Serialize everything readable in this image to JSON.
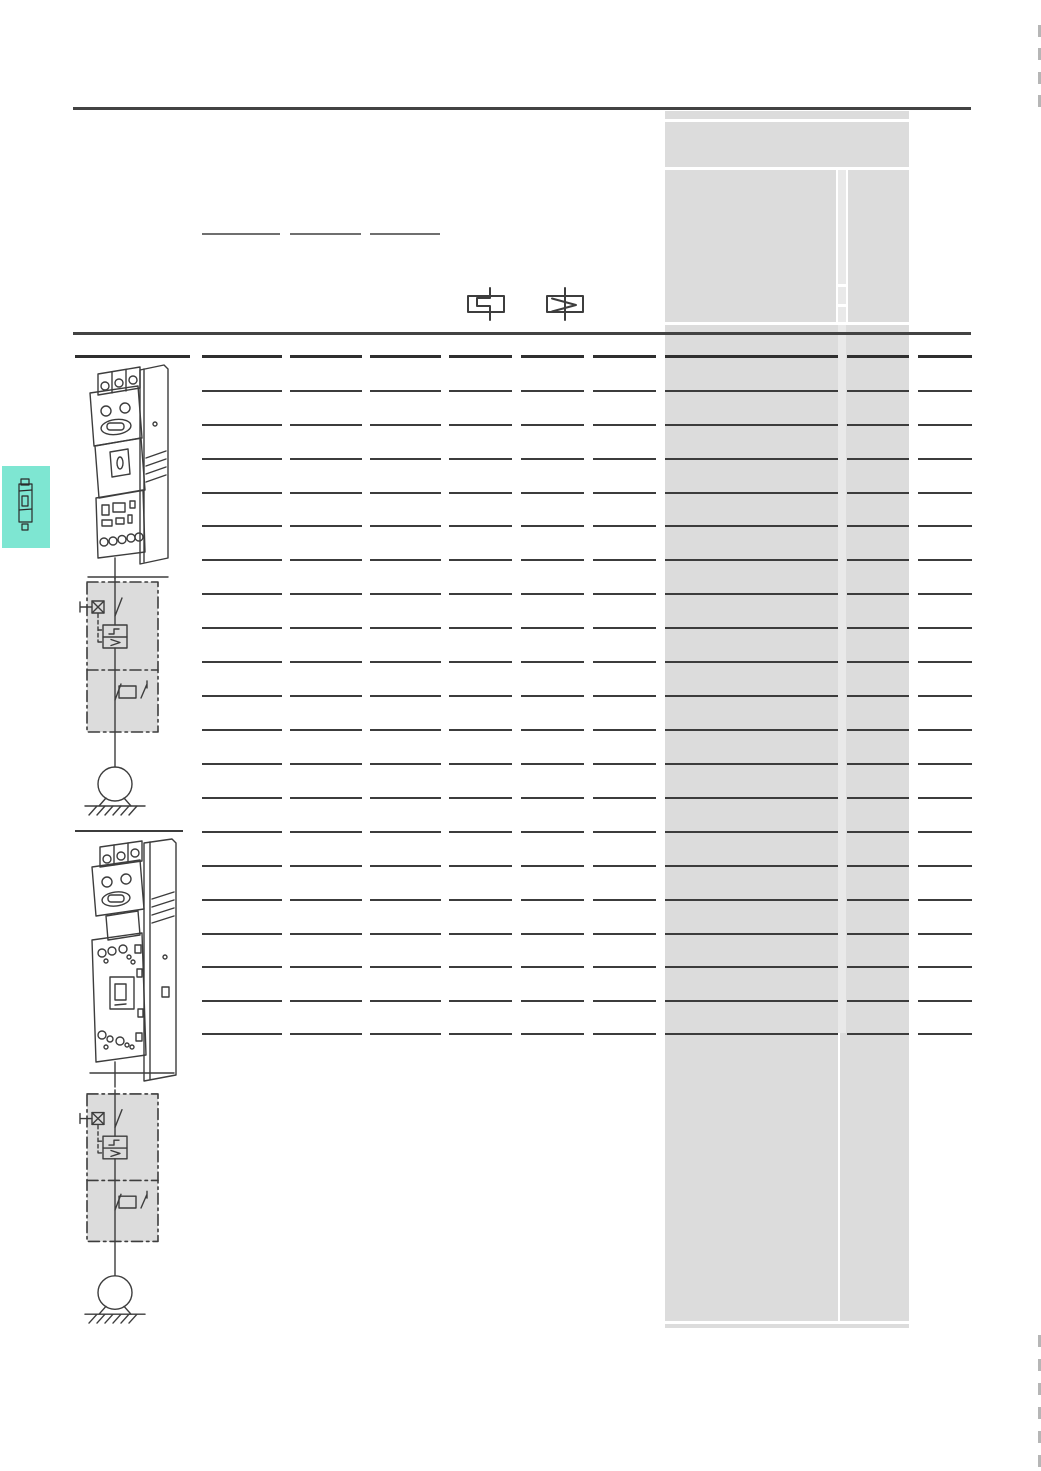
{
  "page": {
    "width": 1041,
    "height": 1471,
    "background": "#ffffff"
  },
  "colors": {
    "rule": "#434343",
    "panel": "#dcdcdc",
    "panel_strip": "#e9e9e9",
    "panel_divider": "#ffffff",
    "header_line": "#2f2f2f",
    "table_line": "#3c3c3c",
    "placeholder_line": "#6f6f6f",
    "edge_tick": "#b6b6b6",
    "tab": "#7ee6d2",
    "drawing_stroke": "#3d3d3d"
  },
  "header": {
    "top_rule": {
      "x": 73,
      "y": 107,
      "width": 898,
      "height": 3
    },
    "placeholder_lines": {
      "y": 233,
      "height": 2,
      "segments": [
        [
          202,
          280
        ],
        [
          290,
          361
        ],
        [
          370,
          440
        ]
      ]
    },
    "symbols": [
      {
        "name": "thermal-overload-release-symbol"
      },
      {
        "name": "magnetic-overcurrent-release-symbol"
      }
    ],
    "bottom_rule": {
      "x": 73,
      "y": 332,
      "width": 898,
      "height": 3
    }
  },
  "info_panel": {
    "x": 665,
    "y": 111,
    "width": 244,
    "height": 1217,
    "h_dividers_rel": [
      8,
      56,
      211,
      1210
    ],
    "v_divider_span": [
      58,
      211
    ],
    "strip": {
      "x_rel": 173,
      "width": 8,
      "top_rel": 58,
      "bottom_rel": 922
    },
    "strip_dividers_rel": [
      173,
      193
    ],
    "bottom_vline": {
      "x_rel": 173,
      "top_rel": 922,
      "bottom_rel": 1210
    }
  },
  "table": {
    "row_count": 20,
    "column_count": 10,
    "header_line": {
      "y": 355,
      "height": 2.5,
      "segments": [
        [
          75,
          190
        ],
        [
          202,
          282
        ],
        [
          290,
          362
        ],
        [
          370,
          441
        ],
        [
          449,
          512
        ],
        [
          521,
          584
        ],
        [
          593,
          656
        ],
        [
          665,
          838
        ],
        [
          847,
          909
        ],
        [
          918,
          972
        ]
      ]
    },
    "row_lines": {
      "ys": [
        390,
        424,
        458,
        492,
        525,
        559,
        593,
        627,
        661,
        695,
        729,
        763,
        797,
        831,
        865,
        899,
        933,
        966,
        1000,
        1033
      ],
      "height": 2,
      "segments": [
        [
          202,
          282
        ],
        [
          290,
          362
        ],
        [
          370,
          441
        ],
        [
          449,
          512
        ],
        [
          521,
          584
        ],
        [
          593,
          656
        ],
        [
          665,
          838
        ],
        [
          847,
          909
        ],
        [
          918,
          972
        ]
      ]
    }
  },
  "sections": [
    {
      "name": "motor-starter-view-1"
    },
    {
      "name": "motor-starter-view-2",
      "separator": {
        "x": 75,
        "y": 830,
        "width": 108,
        "height": 2
      }
    }
  ],
  "side_tab": {
    "x": 2,
    "y": 466,
    "width": 48,
    "height": 82
  },
  "edge_marks": {
    "x": 1037.5,
    "width": 3,
    "tick_height": 12,
    "top_ys": [
      25,
      48,
      72,
      95
    ],
    "bottom_ys": [
      1335,
      1359,
      1383,
      1407,
      1431,
      1455
    ]
  }
}
